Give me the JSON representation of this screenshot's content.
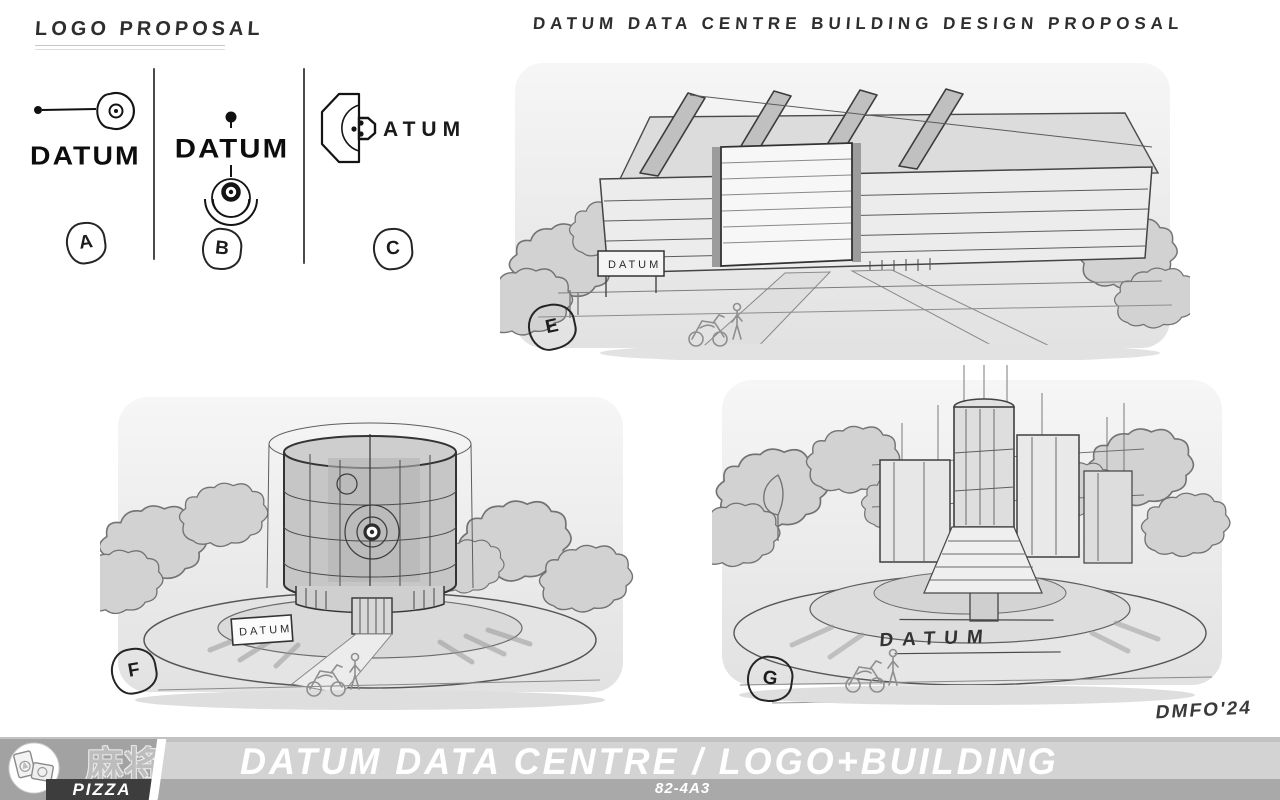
{
  "logo_section": {
    "heading": "LOGO PROPOSAL",
    "options": [
      {
        "label": "A",
        "wordmark": "DATUM"
      },
      {
        "label": "B",
        "wordmark": "DATUM"
      },
      {
        "label": "C",
        "wordmark": "ATUM"
      }
    ]
  },
  "building_section": {
    "heading": "DATUM DATA CENTRE BUILDING DESIGN PROPOSAL",
    "sketches": [
      {
        "label": "E",
        "sign_text": "DATUM"
      },
      {
        "label": "F",
        "sign_text": "DATUM"
      },
      {
        "label": "G",
        "sign_text": "DATUM"
      }
    ]
  },
  "signature": "DMFO'24",
  "footer": {
    "title": "DATUM DATA CENTRE / LOGO+BUILDING",
    "sheet_code": "82-4A3",
    "brand_cjk": "麻将",
    "brand_latin": "PIZZA"
  },
  "colors": {
    "ink": "#2e2e2e",
    "footer_band_light": "#d3d3d3",
    "footer_band_mid": "#a9a9a9",
    "footer_brand_dark": "#3d3d3d"
  }
}
